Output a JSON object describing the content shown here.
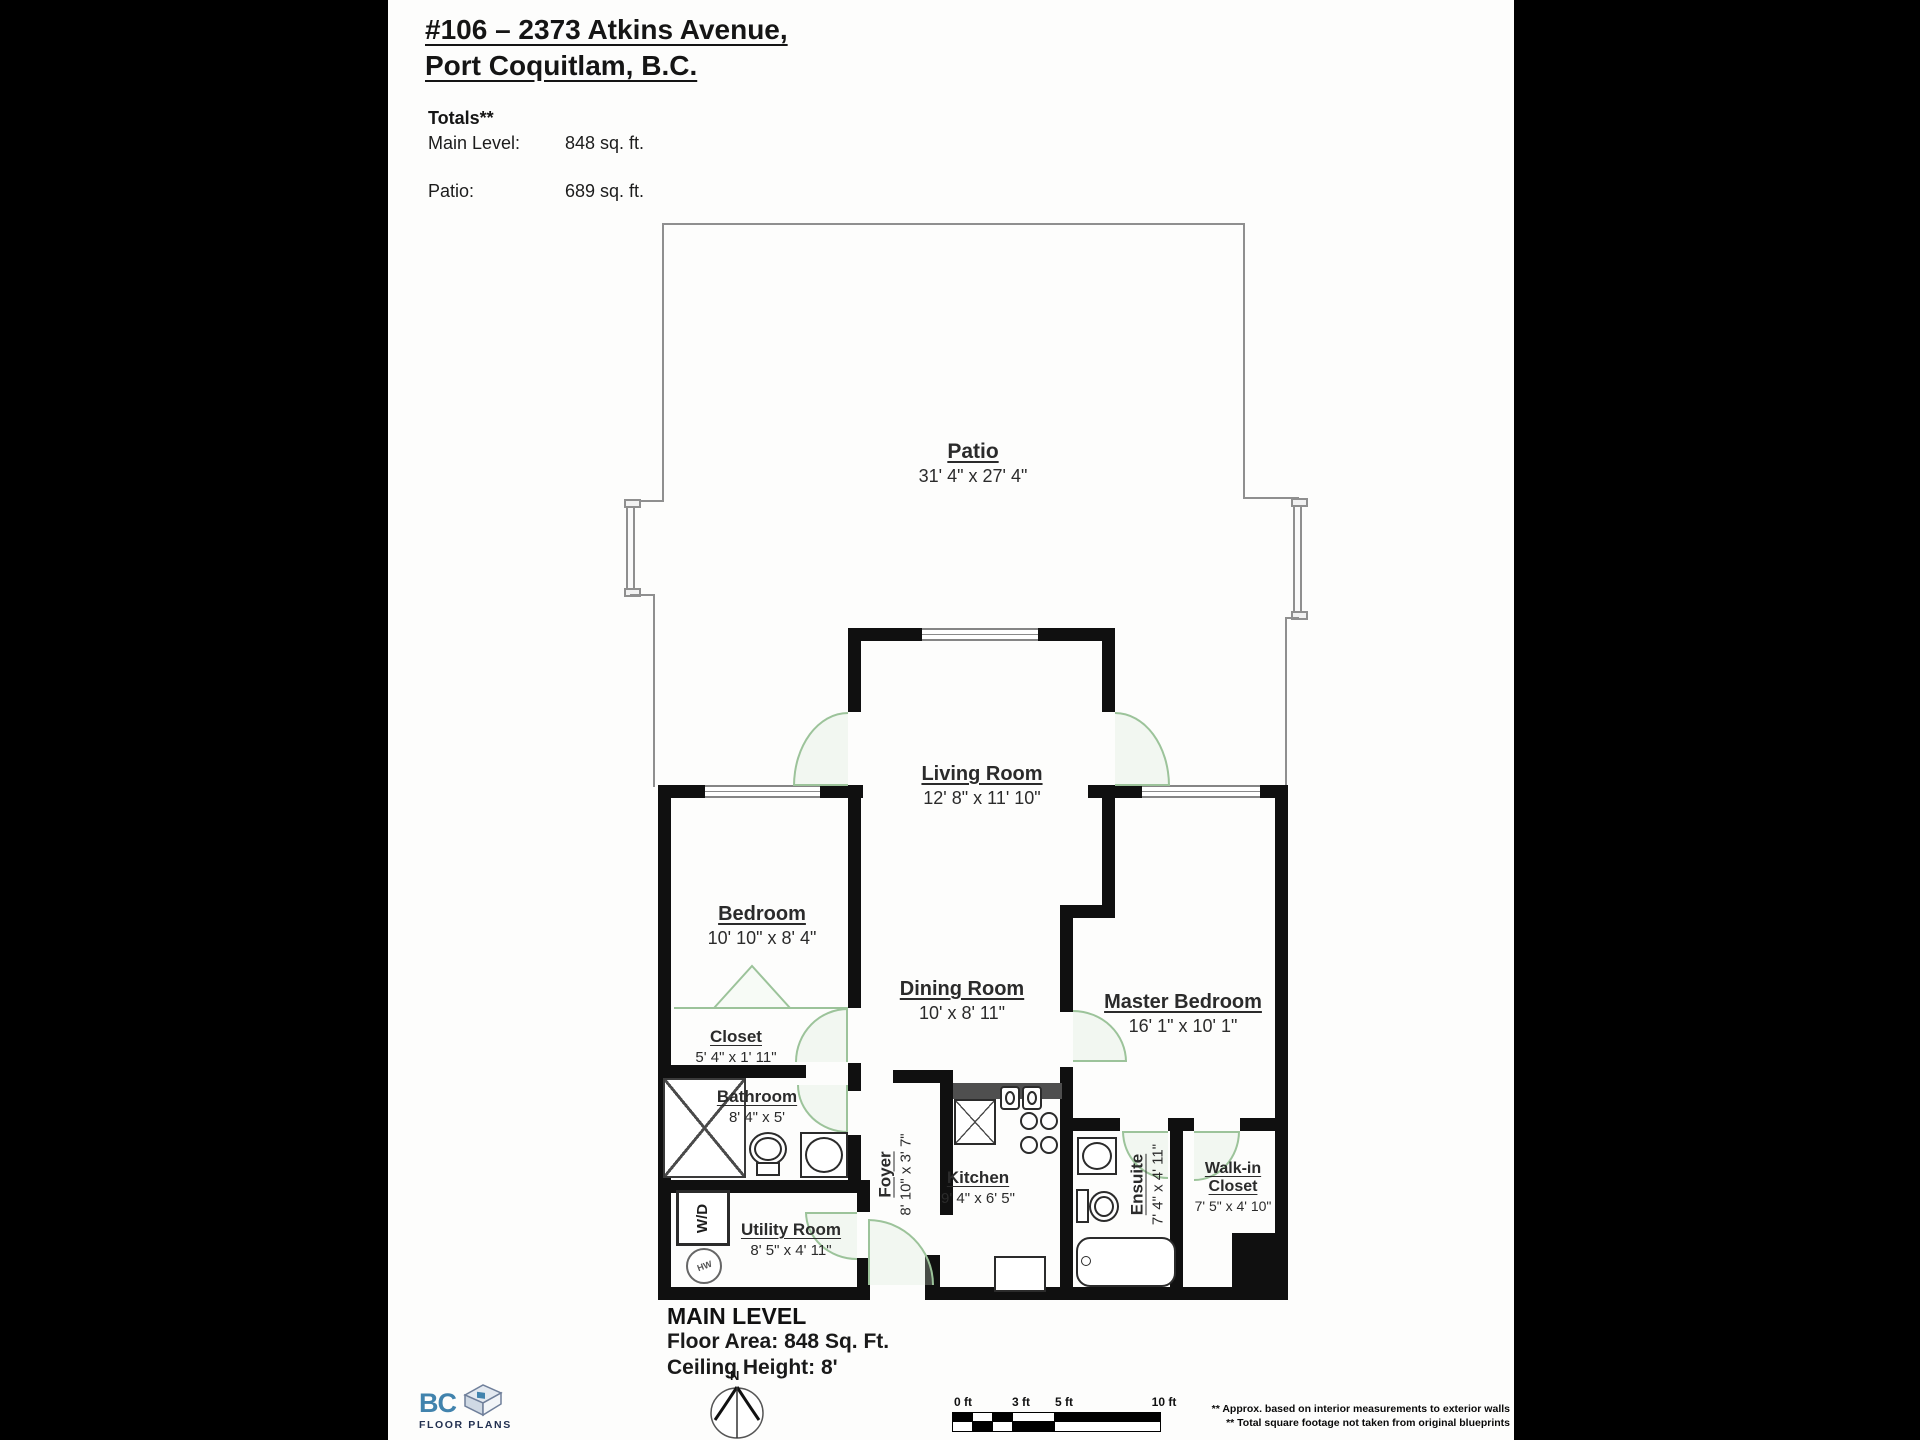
{
  "header": {
    "title_line1": "#106 – 2373 Atkins Avenue,",
    "title_line2": "Port Coquitlam, B.C.",
    "totals_label": "Totals**",
    "totals": [
      {
        "label": "Main Level:",
        "value": "848 sq. ft."
      },
      {
        "label": "Patio:",
        "value": "689 sq. ft."
      }
    ]
  },
  "rooms": {
    "patio": {
      "name": "Patio",
      "dims": "31' 4\" x 27' 4\""
    },
    "living": {
      "name": "Living Room",
      "dims": "12' 8\" x 11' 10\""
    },
    "bedroom": {
      "name": "Bedroom",
      "dims": "10' 10\" x 8' 4\""
    },
    "dining": {
      "name": "Dining Room",
      "dims": "10' x 8' 11\""
    },
    "master": {
      "name": "Master Bedroom",
      "dims": "16' 1\" x 10' 1\""
    },
    "closet": {
      "name": "Closet",
      "dims": "5' 4\" x 1' 11\""
    },
    "bathroom": {
      "name": "Bathroom",
      "dims": "8' 4\" x 5'"
    },
    "foyer": {
      "name": "Foyer",
      "dims": "8' 10\" x 3' 7\""
    },
    "kitchen": {
      "name": "Kitchen",
      "dims": "9' 4\" x 6' 5\""
    },
    "utility": {
      "name": "Utility Room",
      "dims": "8' 5\" x 4' 11\""
    },
    "ensuite": {
      "name": "Ensuite",
      "dims": "7' 4\" x 4' 11\""
    },
    "walkin": {
      "name_line1": "Walk-in",
      "name_line2": "Closet",
      "dims": "7' 5\" x 4' 10\""
    }
  },
  "fixtures": {
    "washer_dryer_label": "W/D",
    "hot_water_label": "HW"
  },
  "footer": {
    "level_title": "MAIN LEVEL",
    "floor_area": "Floor Area: 848 Sq. Ft.",
    "ceiling": "Ceiling Height: 8'",
    "compass_n": "N",
    "scale_labels": [
      "0 ft",
      "3 ft",
      "5 ft",
      "10 ft"
    ],
    "logo_bc": "BC",
    "logo_floorplans": "FLOOR PLANS",
    "disclaimer_line1": "** Approx. based on interior measurements to exterior walls",
    "disclaimer_line2": "** Total square footage not taken from original blueprints"
  },
  "colors": {
    "wall": "#101010",
    "door_green": "#9cc39a",
    "patio_outline": "#8f8f8f",
    "counter_gray": "#4f4f4f",
    "logo_blue": "#4183ad",
    "logo_navy": "#223050"
  }
}
